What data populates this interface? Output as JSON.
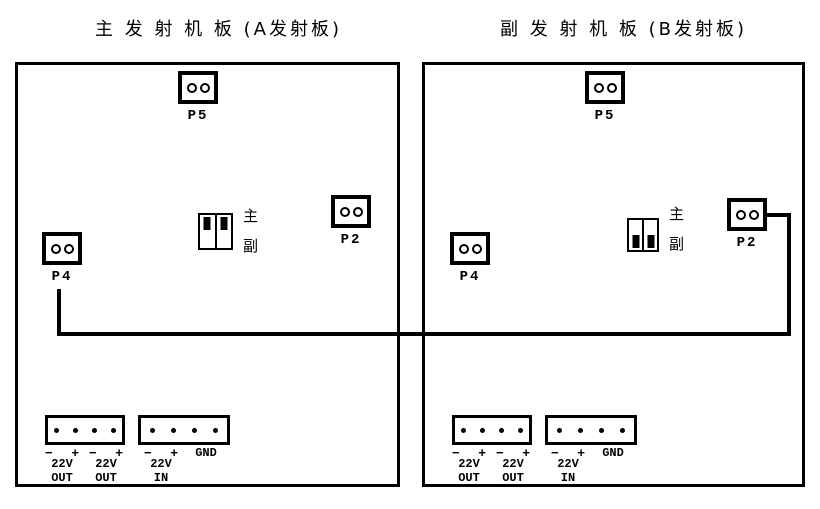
{
  "page": {
    "background": "#ffffff",
    "ink": "#000000"
  },
  "boards": [
    {
      "title": "主 发 射 机 板 (A发射板)",
      "p5_label": "P5",
      "p2_label": "P2",
      "p4_label": "P4",
      "jumper": {
        "top_label": "主",
        "bottom_label": "副",
        "selected": "主"
      },
      "power": {
        "groups": [
          {
            "minus": "−",
            "plus": "+",
            "volt": "22V",
            "dir": "OUT"
          },
          {
            "minus": "−",
            "plus": "+",
            "volt": "22V",
            "dir": "OUT"
          },
          {
            "minus": "−",
            "plus": "+",
            "volt": "22V",
            "dir": "IN"
          }
        ],
        "gnd": "GND"
      }
    },
    {
      "title": "副 发 射 机 板 (B发射板)",
      "p5_label": "P5",
      "p2_label": "P2",
      "p4_label": "P4",
      "jumper": {
        "top_label": "主",
        "bottom_label": "副",
        "selected": "副"
      },
      "power": {
        "groups": [
          {
            "minus": "−",
            "plus": "+",
            "volt": "22V",
            "dir": "OUT"
          },
          {
            "minus": "−",
            "plus": "+",
            "volt": "22V",
            "dir": "OUT"
          },
          {
            "minus": "−",
            "plus": "+",
            "volt": "22V",
            "dir": "IN"
          }
        ],
        "gnd": "GND"
      }
    }
  ]
}
